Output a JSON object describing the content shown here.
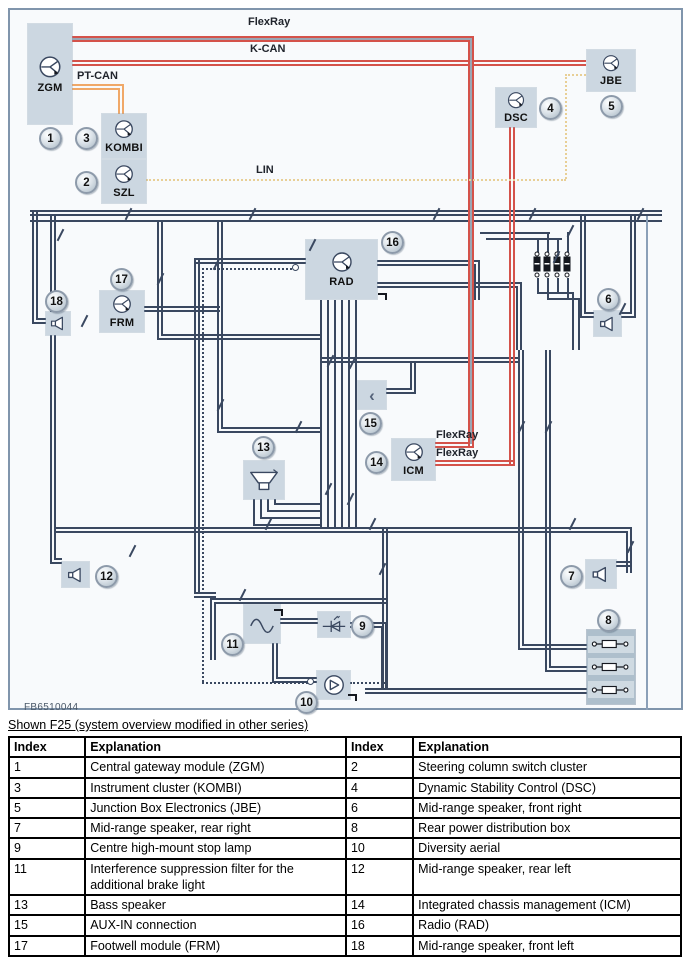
{
  "diagram": {
    "figure_id": "FB6510044",
    "modules": {
      "zgm": "ZGM",
      "kombi": "KOMBI",
      "szl": "SZL",
      "dsc": "DSC",
      "jbe": "JBE",
      "rad": "RAD",
      "frm": "FRM",
      "icm": "ICM"
    },
    "bus_labels": {
      "flexray": "FlexRay",
      "kcan": "K-CAN",
      "ptcan": "PT-CAN",
      "lin": "LIN",
      "icm_flexray_upper": "FlexRay",
      "icm_flexray_lower": "FlexRay"
    },
    "badges": {
      "n1": "1",
      "n2": "2",
      "n3": "3",
      "n4": "4",
      "n5": "5",
      "n6": "6",
      "n7": "7",
      "n8": "8",
      "n9": "9",
      "n10": "10",
      "n11": "11",
      "n12": "12",
      "n13": "13",
      "n14": "14",
      "n15": "15",
      "n16": "16",
      "n17": "17",
      "n18": "18"
    },
    "icons": {
      "aux_jack": "‹"
    },
    "colors": {
      "wire": "#3a4860",
      "bus-red": "#d4524a",
      "bus-orange": "#f0a868",
      "bus-lin": "#e8cf96",
      "module-fill": "#ccd7e1",
      "panel-border": "#8095ac",
      "badge-border": "#8d9aaa"
    }
  },
  "caption": "Shown F25 (system overview modified in other series)",
  "table": {
    "headers": [
      "Index",
      "Explanation",
      "Index",
      "Explanation"
    ],
    "rows": [
      [
        "1",
        "Central gateway module (ZGM)",
        "2",
        "Steering column switch cluster"
      ],
      [
        "3",
        "Instrument cluster (KOMBI)",
        "4",
        "Dynamic Stability Control (DSC)"
      ],
      [
        "5",
        "Junction Box Electronics (JBE)",
        "6",
        "Mid-range speaker, front right"
      ],
      [
        "7",
        "Mid-range speaker, rear right",
        "8",
        "Rear power distribution box"
      ],
      [
        "9",
        "Centre high-mount stop lamp",
        "10",
        "Diversity aerial"
      ],
      [
        "11",
        "Interference suppression filter for the additional brake light",
        "12",
        "Mid-range speaker, rear left"
      ],
      [
        "13",
        "Bass speaker",
        "14",
        "Integrated chassis management (ICM)"
      ],
      [
        "15",
        "AUX-IN connection",
        "16",
        "Radio (RAD)"
      ],
      [
        "17",
        "Footwell module (FRM)",
        "18",
        "Mid-range speaker, front left"
      ]
    ]
  }
}
